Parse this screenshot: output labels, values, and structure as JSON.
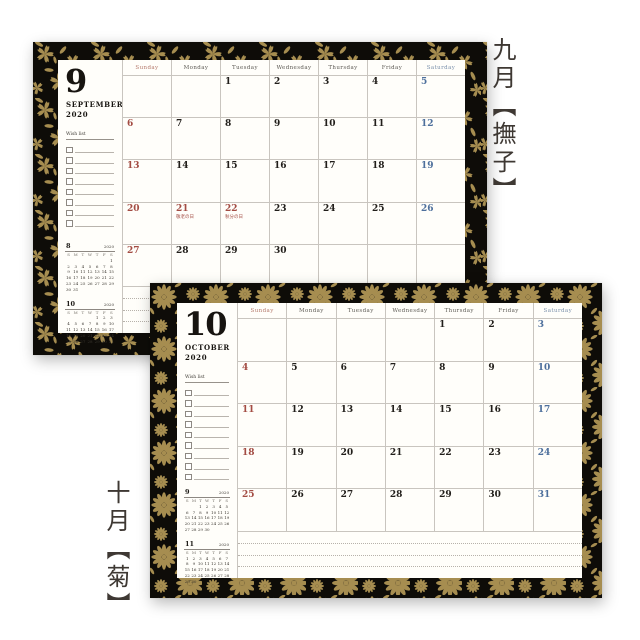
{
  "colors": {
    "gold": "#a68d50",
    "black": "#0e0c08",
    "holiday_red": "#a34c43",
    "saturday_blue": "#4d6f9c",
    "paper": "#fffefa"
  },
  "weekday_labels": [
    "Sunday",
    "Monday",
    "Tuesday",
    "Wednesday",
    "Thursday",
    "Friday",
    "Saturday"
  ],
  "mini_day_letters": [
    "S",
    "M",
    "T",
    "W",
    "T",
    "F",
    "S"
  ],
  "pages": [
    {
      "id": "september",
      "caption": "九月【撫子】",
      "pattern_name": "nadeshiko",
      "month_number": "9",
      "month_name": "SEPTEMBER",
      "year": "2020",
      "wishlist_label": "Wish list",
      "wishlist_rows": 8,
      "note_lines": 3,
      "holidays": {
        "21": "敬老の日",
        "22": "秋分の日"
      },
      "weeks": [
        [
          null,
          null,
          1,
          2,
          3,
          4,
          5
        ],
        [
          6,
          7,
          8,
          9,
          10,
          11,
          12
        ],
        [
          13,
          14,
          15,
          16,
          17,
          18,
          19
        ],
        [
          20,
          21,
          22,
          23,
          24,
          25,
          26
        ],
        [
          27,
          28,
          29,
          30,
          null,
          null,
          null
        ]
      ],
      "mini_calendars": [
        {
          "month": "8",
          "year": "2020",
          "weeks": [
            [
              null,
              null,
              null,
              null,
              null,
              null,
              1
            ],
            [
              2,
              3,
              4,
              5,
              6,
              7,
              8
            ],
            [
              9,
              10,
              11,
              12,
              13,
              14,
              15
            ],
            [
              16,
              17,
              18,
              19,
              20,
              21,
              22
            ],
            [
              23,
              24,
              25,
              26,
              27,
              28,
              29
            ],
            [
              30,
              31,
              null,
              null,
              null,
              null,
              null
            ]
          ]
        },
        {
          "month": "10",
          "year": "2020",
          "weeks": [
            [
              null,
              null,
              null,
              null,
              1,
              2,
              3
            ],
            [
              4,
              5,
              6,
              7,
              8,
              9,
              10
            ],
            [
              11,
              12,
              13,
              14,
              15,
              16,
              17
            ],
            [
              18,
              19,
              20,
              21,
              22,
              23,
              24
            ],
            [
              25,
              26,
              27,
              28,
              29,
              30,
              31
            ]
          ]
        }
      ]
    },
    {
      "id": "october",
      "caption": "十月【菊】",
      "pattern_name": "kiku",
      "month_number": "10",
      "month_name": "OCTOBER",
      "year": "2020",
      "wishlist_label": "Wish list",
      "wishlist_rows": 9,
      "note_lines": 3,
      "holidays": {},
      "weeks": [
        [
          null,
          null,
          null,
          null,
          1,
          2,
          3
        ],
        [
          4,
          5,
          6,
          7,
          8,
          9,
          10
        ],
        [
          11,
          12,
          13,
          14,
          15,
          16,
          17
        ],
        [
          18,
          19,
          20,
          21,
          22,
          23,
          24
        ],
        [
          25,
          26,
          27,
          28,
          29,
          30,
          31
        ]
      ],
      "mini_calendars": [
        {
          "month": "9",
          "year": "2020",
          "weeks": [
            [
              null,
              null,
              1,
              2,
              3,
              4,
              5
            ],
            [
              6,
              7,
              8,
              9,
              10,
              11,
              12
            ],
            [
              13,
              14,
              15,
              16,
              17,
              18,
              19
            ],
            [
              20,
              21,
              22,
              23,
              24,
              25,
              26
            ],
            [
              27,
              28,
              29,
              30,
              null,
              null,
              null
            ]
          ]
        },
        {
          "month": "11",
          "year": "2020",
          "weeks": [
            [
              1,
              2,
              3,
              4,
              5,
              6,
              7
            ],
            [
              8,
              9,
              10,
              11,
              12,
              13,
              14
            ],
            [
              15,
              16,
              17,
              18,
              19,
              20,
              21
            ],
            [
              22,
              23,
              24,
              25,
              26,
              27,
              28
            ],
            [
              29,
              30,
              null,
              null,
              null,
              null,
              null
            ]
          ]
        }
      ]
    }
  ]
}
